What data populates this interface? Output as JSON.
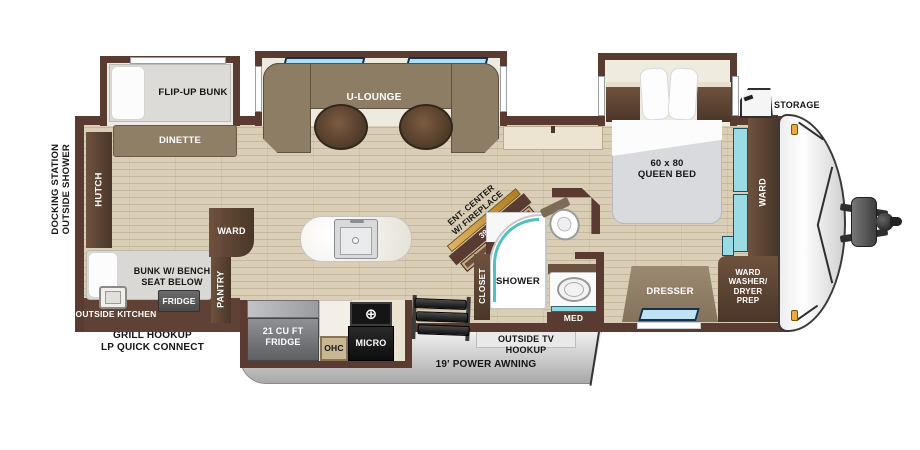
{
  "figure": {
    "type": "rv-travel-trailer-floorplan"
  },
  "colors": {
    "wall": "#5a3b31",
    "floor": "#dacfb6",
    "dark_wood": "#5d4634",
    "mid_wood": "#8d7a62",
    "sofa": "#8c7d64",
    "mattress": "#d9dade",
    "teal_accent": "#9adbe4",
    "window_blue": "#aee0f5",
    "awning_gray": "#c9c9c9",
    "fireplace_gold": "#c79b4e",
    "appliance_black": "#1c1c1c",
    "marker_orange": "#efa93f"
  },
  "exterior": {
    "docking": "DOCKING STATION\nOUTSIDE SHOWER",
    "grill": "GRILL HOOKUP\nLP QUICK CONNECT",
    "storage": "STORAGE",
    "outside_kitchen": "OUTSIDE KITCHEN",
    "outside_tv": "OUTSIDE TV HOOKUP",
    "awning": "19' POWER AWNING"
  },
  "bunkroom": {
    "flip_up_bunk": "FLIP-UP BUNK",
    "dinette": "DINETTE",
    "hutch": "HUTCH",
    "bunk_bench": "BUNK W/ BENCH\nSEAT BELOW",
    "fridge": "FRIDGE",
    "ward": "WARD",
    "pantry": "PANTRY"
  },
  "living": {
    "u_lounge": "U-LOUNGE",
    "ent_center": "ENT. CENTER\nW/ FIREPLACE",
    "tv": "39\" TV"
  },
  "kitchen": {
    "fridge_21": "21 CU FT\nFRIDGE",
    "ohc": "OHC",
    "micro": "MICRO"
  },
  "bath": {
    "linen": "LINEN",
    "closet": "CLOSET",
    "shower": "SHOWER",
    "med": "MED"
  },
  "bedroom": {
    "queen_bed": "60 x 80\nQUEEN BED",
    "dresser": "DRESSER",
    "ward_front": "WARD",
    "ward_wd": "WARD\nWASHER/\nDRYER\nPREP"
  }
}
